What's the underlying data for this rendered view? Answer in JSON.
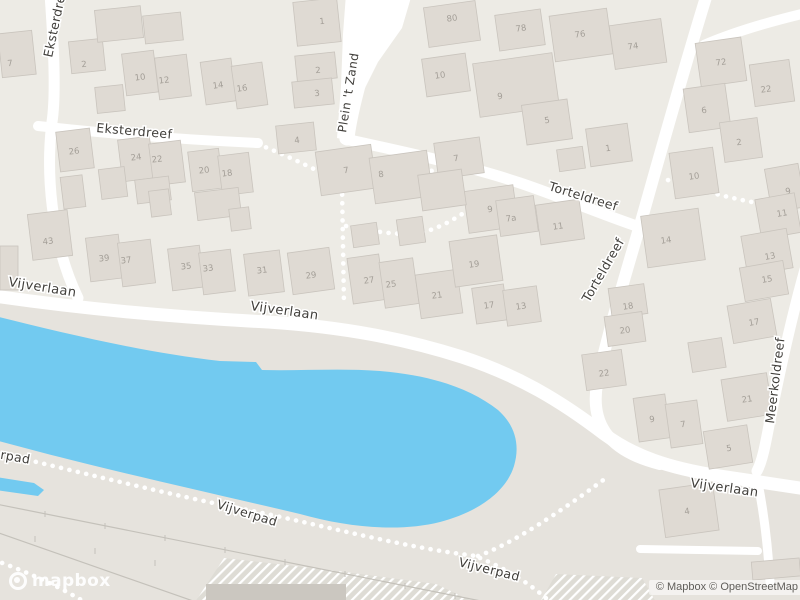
{
  "map": {
    "colors": {
      "land_north": "#EDEBE5",
      "land_south": "#E6E3DD",
      "water": "#72CAF0",
      "building": "#DFDAD3",
      "building_stroke": "#C9C4BD",
      "building_dark": "#CBC7C0",
      "road": "#FFFFFF",
      "rail": "#C4C1BA",
      "street_label": "#403E3A",
      "label_halo": "#FFFFFF",
      "house_number": "#A39E97",
      "hatch_base": "#DEDCD5"
    },
    "street_labels": [
      {
        "t": "Eksterdreef",
        "x": 52,
        "y": 58,
        "r": -78,
        "s": 12.5
      },
      {
        "t": "Eksterdreef",
        "x": 96,
        "y": 132,
        "r": 5,
        "s": 12.5
      },
      {
        "t": "Plein 't Zand",
        "x": 346,
        "y": 133,
        "r": -81,
        "s": 12
      },
      {
        "t": "Torteldreef",
        "x": 548,
        "y": 190,
        "r": 17,
        "s": 12.5
      },
      {
        "t": "Torteldreef",
        "x": 589,
        "y": 303,
        "r": -60,
        "s": 12.5
      },
      {
        "t": "Meerkoldreef",
        "x": 774,
        "y": 424,
        "r": -83,
        "s": 12.5
      },
      {
        "t": "Vijverlaan",
        "x": 8,
        "y": 286,
        "r": 9,
        "s": 13
      },
      {
        "t": "Vijverlaan",
        "x": 250,
        "y": 310,
        "r": 8,
        "s": 13
      },
      {
        "t": "Vijverlaan",
        "x": 690,
        "y": 487,
        "r": 8,
        "s": 13
      },
      {
        "t": "Vijverpad",
        "x": -32,
        "y": 453,
        "r": 10,
        "s": 12.5
      },
      {
        "t": "Vijverpad",
        "x": 216,
        "y": 508,
        "r": 17,
        "s": 12.5
      },
      {
        "t": "Vijverpad",
        "x": 458,
        "y": 566,
        "r": 14,
        "s": 12.5
      }
    ],
    "roads": [
      {
        "d": "M 50,-6 C 54,50 56,95 52,122 C 46,170 50,240 78,298",
        "w": 11
      },
      {
        "d": "M 38,126 C 110,134 190,140 258,143",
        "w": 10
      },
      {
        "d": "M 360,78 C 354,100 349,120 347,138",
        "w": 15
      },
      {
        "d": "M 345,139 C 400,151 470,166 520,183 C 565,198 615,220 652,231",
        "w": 11
      },
      {
        "d": "M 707,-6 C 688,55 664,140 646,204 C 628,268 608,330 597,384 C 591,420 604,450 660,464",
        "w": 12
      },
      {
        "d": "M 806,13 C 768,22 734,32 704,45",
        "w": 10
      },
      {
        "d": "M -6,296 C 90,310 190,318 268,322 C 345,327 405,339 462,357 C 520,376 562,402 604,434 C 634,456 668,468 720,476 L 806,489",
        "w": 13
      },
      {
        "d": "M 806,266 C 794,308 780,370 770,420 C 765,447 762,462 757,471",
        "w": 11
      },
      {
        "d": "M 757,478 C 764,512 768,548 770,582",
        "w": 9
      },
      {
        "d": "M 640,549 L 758,551",
        "w": 8
      }
    ],
    "plaza": "M 346,-6 L 412,-6 L 402,28 L 378,62 L 360,98 L 352,124 L 350,141 L 337,138 L 341,86 L 343,34 Z",
    "paths": [
      "M 258,144 C 292,158 322,172 341,184",
      "M 342,186 L 344,306",
      "M 346,226 C 380,233 406,236 424,232 C 452,224 474,206 498,188",
      "M 404,150 C 426,166 446,182 460,194",
      "M -6,452 C 80,472 170,495 248,510 C 330,527 402,547 476,556",
      "M 478,556 C 512,544 560,512 606,478",
      "M 480,558 C 504,568 528,582 548,600",
      "M -6,560 C 28,572 62,588 88,604",
      "M 668,180 C 716,196 762,205 806,211"
    ],
    "rails": {
      "lines": [
        "M -4,504 L 486,602",
        "M -4,532 L 196,602"
      ],
      "ticks": [
        [
          45,
          514
        ],
        [
          105,
          526
        ],
        [
          165,
          538
        ],
        [
          225,
          550
        ],
        [
          285,
          562
        ],
        [
          345,
          574
        ],
        [
          405,
          586
        ],
        [
          455,
          596
        ],
        [
          35,
          539
        ],
        [
          95,
          551
        ],
        [
          155,
          563
        ]
      ]
    },
    "hatches": [
      "195,602 224,558 330,570 436,584 474,602",
      "540,602 556,574 642,578 656,602"
    ],
    "dark_buildings": [
      [
        206,
        584,
        140,
        16
      ]
    ],
    "water_main": "M -5,316 C 60,332 140,352 220,361 L 256,362 L 262,370 C 300,371 340,368 380,371 C 430,375 470,388 498,410 C 516,426 520,446 514,466 C 506,492 478,512 440,522 C 400,532 350,528 300,514 C 220,495 120,473 40,452 L -5,440 Z",
    "water_sliver": "M -4,477 L 34,483 L 44,490 L 38,496 L -4,490 Z",
    "south_zone": "M -6,294 C 90,309 190,317 268,321 C 345,326 405,338 462,356 C 520,375 562,401 604,433 C 634,455 668,467 720,475 L 806,488 L 806,602 L -6,602 Z",
    "buildings": [
      [
        0,
        32,
        34,
        44,
        -6,
        "7",
        10,
        63
      ],
      [
        70,
        40,
        34,
        32,
        -6,
        "2",
        84,
        64
      ],
      [
        96,
        8,
        46,
        32,
        -6
      ],
      [
        144,
        14,
        38,
        28,
        -6
      ],
      [
        96,
        86,
        28,
        26,
        -6
      ],
      [
        124,
        52,
        32,
        42,
        -7,
        "10",
        140,
        77
      ],
      [
        157,
        56,
        32,
        42,
        -7,
        "12",
        164,
        80
      ],
      [
        203,
        60,
        31,
        43,
        -8,
        "14",
        218,
        85
      ],
      [
        234,
        64,
        31,
        43,
        -8,
        "16",
        242,
        88
      ],
      [
        295,
        0,
        44,
        44,
        -6,
        "1",
        322,
        21
      ],
      [
        296,
        54,
        40,
        26,
        -6,
        "2",
        318,
        70
      ],
      [
        293,
        80,
        40,
        26,
        -6,
        "3",
        317,
        93
      ],
      [
        277,
        124,
        38,
        28,
        -6,
        "4",
        297,
        140
      ],
      [
        426,
        4,
        52,
        40,
        -8,
        "80",
        452,
        18
      ],
      [
        497,
        12,
        46,
        36,
        -8,
        "78",
        521,
        28
      ],
      [
        424,
        56,
        44,
        38,
        -8,
        "10",
        440,
        75
      ],
      [
        476,
        58,
        80,
        54,
        -8,
        "9",
        500,
        96
      ],
      [
        524,
        102,
        46,
        40,
        -8,
        "5",
        547,
        120
      ],
      [
        588,
        126,
        42,
        38,
        -8,
        "1",
        608,
        148
      ],
      [
        436,
        140,
        46,
        36,
        -8,
        "7",
        456,
        158
      ],
      [
        558,
        148,
        26,
        22,
        -8
      ],
      [
        552,
        12,
        58,
        46,
        -8,
        "76",
        580,
        34
      ],
      [
        612,
        22,
        52,
        44,
        -8,
        "74",
        633,
        46
      ],
      [
        698,
        40,
        46,
        44,
        -8,
        "72",
        721,
        62
      ],
      [
        752,
        62,
        40,
        42,
        -8,
        "22",
        766,
        89
      ],
      [
        686,
        86,
        42,
        44,
        -8,
        "6",
        704,
        110
      ],
      [
        722,
        120,
        38,
        40,
        -8,
        "2",
        739,
        142
      ],
      [
        768,
        166,
        34,
        44,
        -10,
        "9",
        788,
        191
      ],
      [
        758,
        196,
        40,
        40,
        -10,
        "11",
        782,
        213
      ],
      [
        744,
        232,
        46,
        40,
        -10,
        "13",
        770,
        256
      ],
      [
        742,
        264,
        44,
        34,
        -10,
        "15",
        767,
        279
      ],
      [
        730,
        302,
        44,
        38,
        -10,
        "17",
        754,
        322
      ],
      [
        690,
        340,
        34,
        30,
        -9
      ],
      [
        724,
        376,
        46,
        42,
        -9,
        "21",
        747,
        399
      ],
      [
        706,
        428,
        44,
        38,
        -9,
        "5",
        729,
        448
      ],
      [
        672,
        150,
        44,
        46,
        -8,
        "10",
        694,
        176
      ],
      [
        644,
        212,
        58,
        52,
        -8,
        "14",
        666,
        240
      ],
      [
        610,
        286,
        36,
        30,
        -8,
        "18",
        628,
        306
      ],
      [
        606,
        314,
        38,
        30,
        -8,
        "20",
        625,
        330
      ],
      [
        584,
        352,
        40,
        36,
        -8,
        "22",
        604,
        373
      ],
      [
        636,
        396,
        32,
        44,
        -8,
        "9",
        652,
        419
      ],
      [
        668,
        402,
        32,
        44,
        -8,
        "7",
        683,
        424
      ],
      [
        662,
        486,
        54,
        48,
        -8,
        "4",
        687,
        511
      ],
      [
        752,
        560,
        48,
        18,
        -5
      ],
      [
        290,
        250,
        42,
        42,
        -8,
        "29",
        311,
        275
      ],
      [
        350,
        256,
        32,
        46,
        -8,
        "27",
        369,
        280
      ],
      [
        382,
        260,
        34,
        46,
        -8,
        "25",
        391,
        284
      ],
      [
        418,
        272,
        42,
        44,
        -8,
        "21",
        437,
        295
      ],
      [
        452,
        238,
        48,
        46,
        -8,
        "19",
        474,
        264
      ],
      [
        474,
        286,
        32,
        36,
        -8,
        "17",
        489,
        305
      ],
      [
        505,
        288,
        34,
        36,
        -8,
        "13",
        521,
        306
      ],
      [
        466,
        188,
        50,
        42,
        -8,
        "9",
        490,
        209
      ],
      [
        498,
        198,
        38,
        36,
        -8,
        "7a",
        511,
        218
      ],
      [
        538,
        202,
        44,
        40,
        -8,
        "11",
        558,
        226
      ],
      [
        318,
        148,
        56,
        44,
        -8,
        "7",
        346,
        170
      ],
      [
        372,
        154,
        58,
        46,
        -8,
        "8",
        381,
        174
      ],
      [
        420,
        172,
        44,
        36,
        -8
      ],
      [
        352,
        224,
        26,
        22,
        -8
      ],
      [
        398,
        218,
        26,
        26,
        -8
      ],
      [
        58,
        130,
        34,
        40,
        -7,
        "26",
        74,
        151
      ],
      [
        120,
        138,
        32,
        42,
        -7,
        "24",
        136,
        157
      ],
      [
        151,
        142,
        32,
        42,
        -7,
        "22",
        157,
        159
      ],
      [
        190,
        150,
        31,
        40,
        -7,
        "20",
        204,
        170
      ],
      [
        220,
        154,
        31,
        40,
        -7,
        "18",
        227,
        173
      ],
      [
        30,
        212,
        40,
        46,
        -7,
        "43",
        48,
        241
      ],
      [
        88,
        236,
        33,
        44,
        -7,
        "39",
        104,
        258
      ],
      [
        120,
        241,
        33,
        44,
        -7,
        "37",
        126,
        260
      ],
      [
        170,
        247,
        32,
        42,
        -7,
        "35",
        186,
        266
      ],
      [
        201,
        251,
        32,
        42,
        -7,
        "33",
        208,
        268
      ],
      [
        246,
        252,
        36,
        42,
        -7,
        "31",
        262,
        270
      ],
      [
        100,
        168,
        26,
        30,
        -7
      ],
      [
        136,
        178,
        34,
        24,
        -7
      ],
      [
        196,
        190,
        44,
        28,
        -7
      ],
      [
        230,
        208,
        20,
        22,
        -7
      ],
      [
        62,
        176,
        22,
        32,
        -7
      ],
      [
        0,
        246,
        18,
        44,
        0
      ],
      [
        150,
        190,
        20,
        26,
        -7
      ]
    ],
    "logo": {
      "text": "mapbox"
    },
    "attribution": {
      "text": "© Mapbox © OpenStreetMap"
    }
  }
}
